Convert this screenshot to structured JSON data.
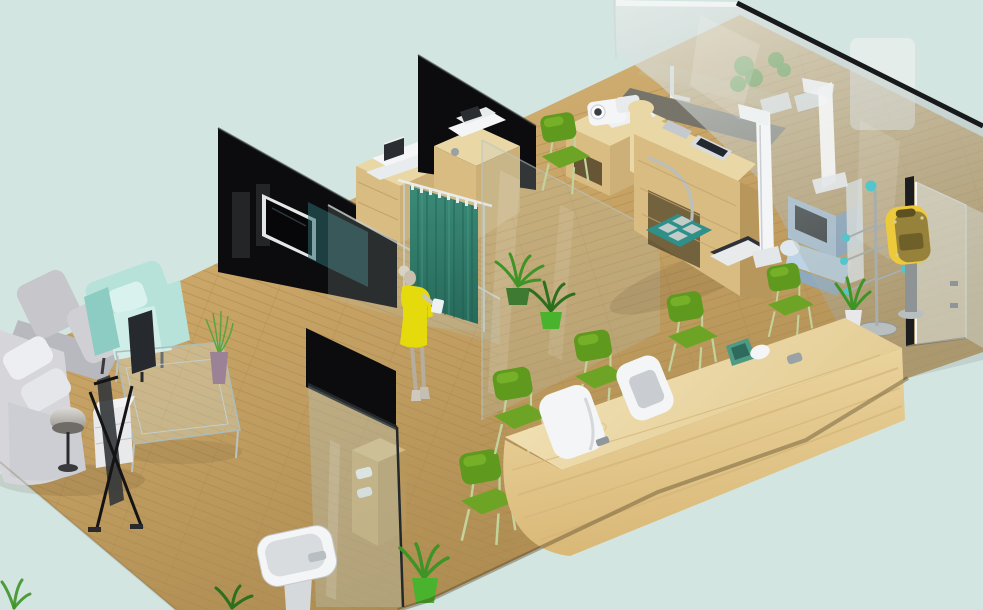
{
  "meta": {
    "title": "3D isometric interior render — health screening clinic showroom",
    "canvas_width": "983",
    "canvas_height": "610",
    "style": "perspective isometric cutaway, no visible text or UI chrome"
  },
  "palette": {
    "bg": "#d3e5e1",
    "floor_light": "#dcbd84",
    "floor_mid": "#c9a567",
    "floor_dark": "#ab8a50",
    "plank_line": "#a9854b",
    "wall_black": "#0c0c0e",
    "wall_highlight": "#2f3437",
    "tv_frame": "#e4e7e8",
    "screen_black": "#070709",
    "wood_light": "#ead7a6",
    "wood_mid": "#d8bc82",
    "wood_side": "#cdb077",
    "wood_dark": "#b7975c",
    "counter_top_a": "#f4e6bd",
    "counter_top_b": "#e3cb92",
    "counter_face_a": "#eed9a5",
    "counter_face_b": "#d9b877",
    "counter_grain": "#d4b678",
    "device_white": "#f4f5f6",
    "device_gray": "#c9cdd1",
    "device_dark": "#2a2e33",
    "chair_green": "#5f9a1f",
    "chair_green_light": "#86c22f",
    "chair_seat": "#6da426",
    "chair_leg": "#c2d39b",
    "curtain_a": "#3a8a77",
    "curtain_b": "#27695a",
    "curtain_fold": "#1f5c4e",
    "curtain_sheen": "#55a38d",
    "glass_fill": "#b9ccc7",
    "glass_edge": "#23282b",
    "glass_teal": "#2e6a6d",
    "chrome": "#cdd4d2",
    "haze_a": "#e6ebe9",
    "haze_b": "#9aa6a3",
    "sofa_gray": "#c6c6cb",
    "sofa_gray2": "#d6d6da",
    "sofa_seat": "#b8b8bf",
    "pillow_white": "#edeef2",
    "armchair_mint": "#b7e2da",
    "armchair_mint_dark": "#8cccc2",
    "armchair_seat": "#cfeee8",
    "lamp_gray": "#8f8b85",
    "kiosk_blue": "#a9c4dd",
    "kiosk_blue_dark": "#7d9fc0",
    "kiosk_seat": "#bcd4e5",
    "mat_teal": "#2f8f89",
    "mat_square": "#c2ccc9",
    "teal_ball": "#52c6cb",
    "dispenser_yellow": "#edc93c",
    "dispenser_olive": "#96823b",
    "dispenser_dark": "#6f5f28",
    "plant_green": "#3f9427",
    "plant_dark": "#2c6f1d",
    "pot_bright_green": "#49b32e",
    "pot_purple": "#9b8296",
    "skin": "#c9bfae",
    "hair": "#d8d2c4",
    "dress_yellow": "#e4da0c",
    "scale_dark": "#2e3236",
    "tray_teal": "#4f9a84",
    "shadow": "#4a3a1e"
  },
  "scene": {
    "areas": [
      {
        "id": "waiting-area",
        "label": "Waiting lounge",
        "items": [
          "gray L-shaped sofa with white pillows",
          "mint armchair",
          "glass coffee table",
          "flat display on table",
          "mushroom floor lamp",
          "white side cabinet",
          "black X banner stand",
          "purple vase with grass plant"
        ]
      },
      {
        "id": "exam-cubicles",
        "label": "Examination cubicles",
        "items": [
          "black partition wall with wall TV",
          "printer cabinet",
          "fax cabinet",
          "teal privacy curtain on glass rail",
          "visitor in yellow dress",
          "glass partitions",
          "potted plants"
        ]
      },
      {
        "id": "measurement-zone",
        "label": "Measurement workstation",
        "items": [
          "wooden workstation with arch",
          "blood-pressure monitor",
          "embedded tablet",
          "chrome rail",
          "white stadiometer x2",
          "weighing scale",
          "teal foot mat"
        ]
      },
      {
        "id": "reception",
        "label": "Reception counter",
        "items": [
          "long curved pine counter",
          "white check-in terminal x2",
          "teal tray",
          "white mouse",
          "green chairs x6"
        ]
      },
      {
        "id": "entrance",
        "label": "Glass entrance wall",
        "items": [
          "full-height gray glass wall",
          "glass door with dark frame",
          "chrome coat rack with teal knobs",
          "yellow ticket dispenser on pole",
          "blue self-service kiosk behind glass",
          "pedestal washbasin",
          "wooden supply shelf behind glass",
          "floor plants"
        ]
      }
    ]
  }
}
